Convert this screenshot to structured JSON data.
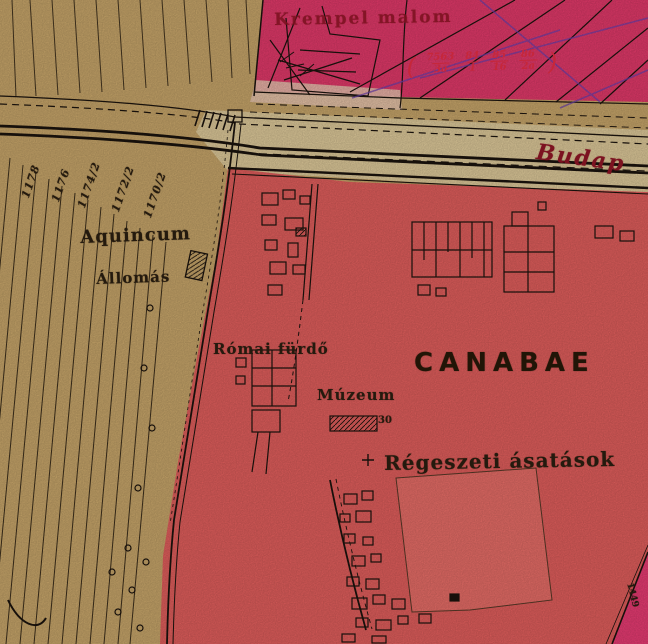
{
  "labels": {
    "mill": "Krempel malom",
    "road": "Budap",
    "station_name": "Aquincum",
    "station_sub": "Állomás",
    "roman_bath": "Római fürdő",
    "museum": "Múzeum",
    "museum_no": "30",
    "canabae": "CANABAE",
    "excavations": "Régeszeti ásatások",
    "corner_parcel": "1449"
  },
  "pink_parcels": {
    "open": "(",
    "close": ")",
    "items": [
      {
        "num": "7563",
        "den": "3a"
      },
      {
        "num": "84",
        "den": "1"
      },
      {
        "num": "85",
        "den": "16"
      },
      {
        "num": "86",
        "den": "2a"
      }
    ]
  },
  "field_numbers": [
    "1178",
    "1176",
    "1174/2",
    "1172/2",
    "1170/2"
  ],
  "colors": {
    "base_tan": "#cdaa6d",
    "road_tan": "#e4cf9e",
    "pink_zone": "#e83b6d",
    "pale_wedge": "#f0cdb6",
    "red_zone": "#e7615f",
    "red_plot": "#ed706a",
    "magenta_strip": "#ee3d76",
    "ink": "#1c140e",
    "dark_red_text": "#7c1220",
    "red_text": "#c6273a",
    "purple_line": "#6f42b5"
  }
}
